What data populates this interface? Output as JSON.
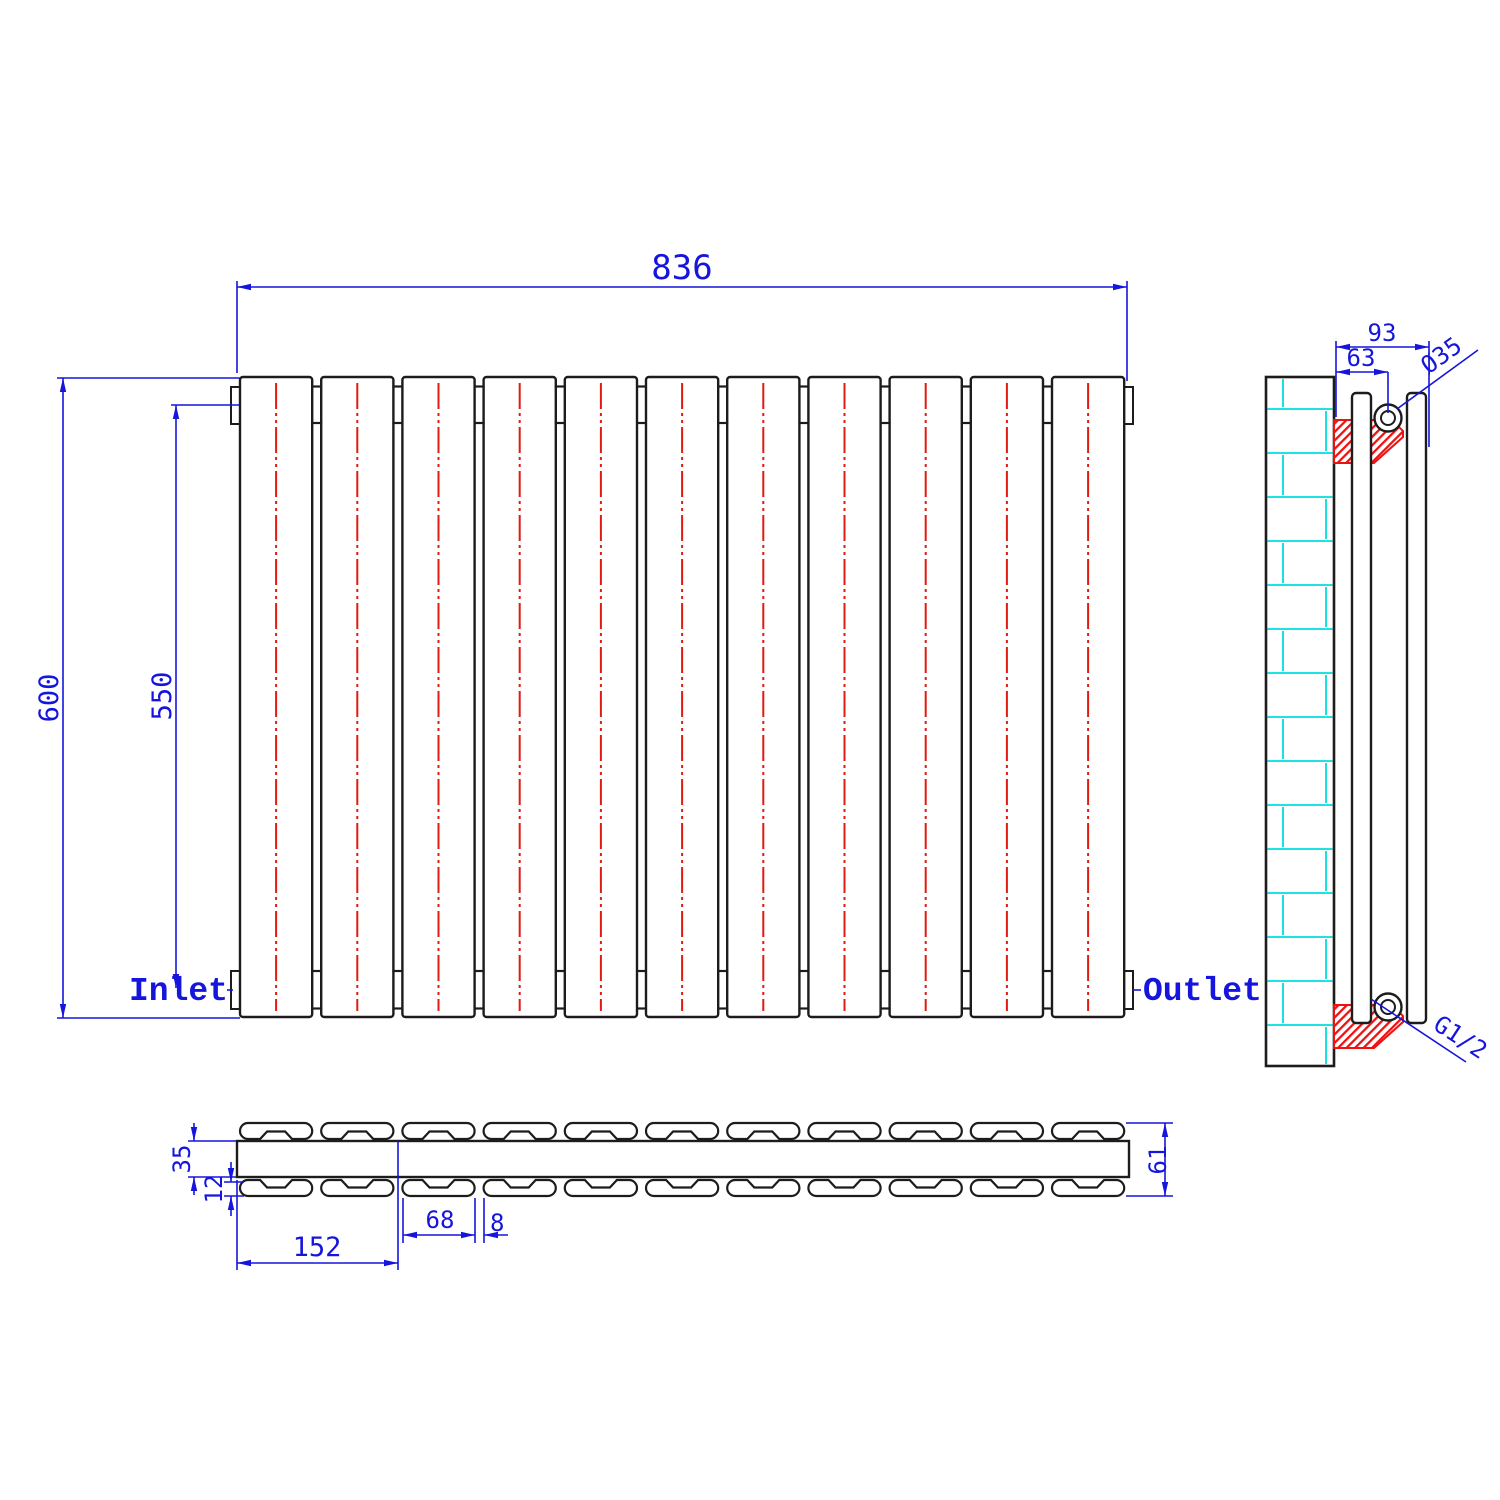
{
  "front_view": {
    "width": "836",
    "height": "600",
    "connection_height": "550",
    "inlet": "Inlet",
    "outlet": "Outlet",
    "panel_count": 11
  },
  "side_view": {
    "depth": "93",
    "hole_offset": "63",
    "hole_diameter": "Ø35",
    "thread": "G1/2",
    "profile_bar_count": 2
  },
  "plan_view": {
    "header_depth": "35",
    "panel_thickness": "12",
    "two_panel_pitch": "152",
    "panel_width": "68",
    "panel_gap": "8",
    "total_depth": "61",
    "panel_count": 11
  },
  "colors": {
    "dimension_blue": "#1515dd",
    "line_black": "#1c1c1c",
    "centerline_red": "#e01b10",
    "hatch_red": "#ee1111",
    "brick_cyan": "#00dede"
  }
}
